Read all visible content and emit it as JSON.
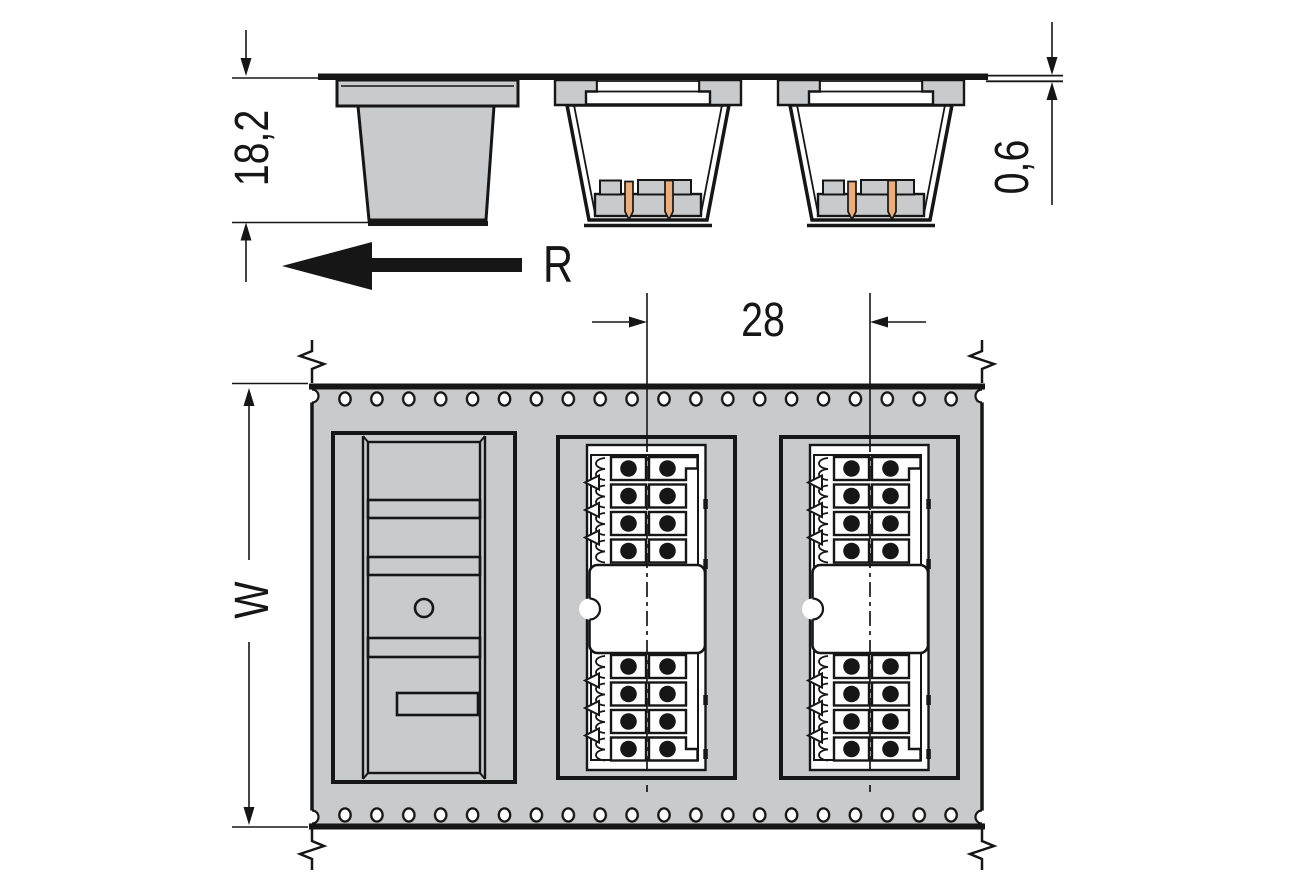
{
  "drawing": {
    "type": "technical-dimension-drawing",
    "side_view": {
      "dim_height": "18,2",
      "dim_tape_thickness": "0,6",
      "unreeling_direction_label": "R"
    },
    "top_view": {
      "dim_pocket_pitch": "28",
      "dim_tape_width_label": "W"
    },
    "counts": {
      "pockets_shown": 3,
      "empty_pockets": 1,
      "loaded_pockets": 2,
      "sprocket_hole_rows": 2,
      "sprocket_holes_per_row": 20,
      "contact_rows_per_connector": 8,
      "contact_columns_per_connector": 2,
      "solder_pins_per_pocket_side_view": 2
    },
    "colors": {
      "background": "#ffffff",
      "line": "#161616",
      "tape-fill": "#c9cacb",
      "pin": "#edad79",
      "connector-body": "#ffffff"
    }
  }
}
